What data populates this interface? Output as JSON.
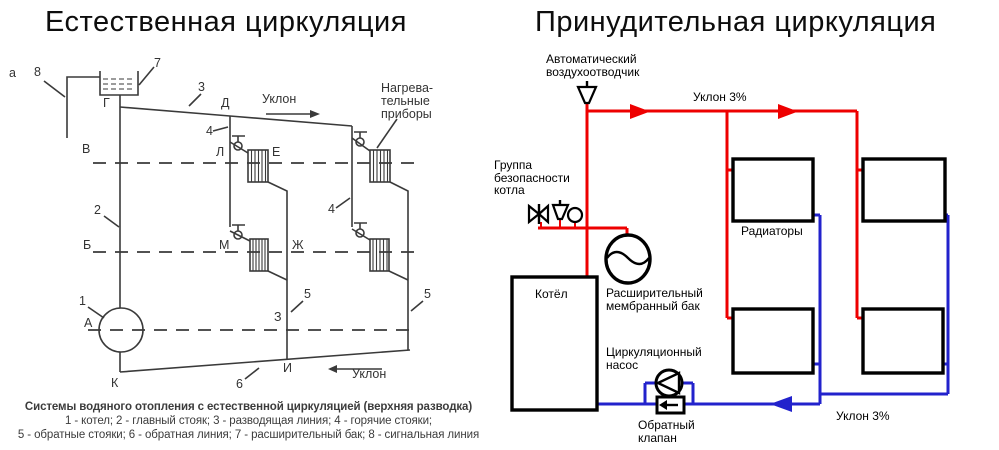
{
  "colors": {
    "supply_red": "#ee0000",
    "return_blue": "#2222cc",
    "scan_gray": "#3a3a3a"
  },
  "left": {
    "title": "Естественная циркуляция",
    "fig_label": "а",
    "slope_top": "Уклон",
    "slope_bottom": "Уклон",
    "heaters": [
      "Нагрева-",
      "тельные",
      "приборы"
    ],
    "num_labels": {
      "n1": "1",
      "n2": "2",
      "n3": "3",
      "n4a": "4",
      "n4b": "4",
      "n5a": "5",
      "n5b": "5",
      "n6": "6",
      "n7": "7",
      "n8": "8"
    },
    "point_labels": {
      "G": "Г",
      "D": "Д",
      "V": "В",
      "L": "Л",
      "E": "Е",
      "B": "Б",
      "M": "М",
      "Zh": "Ж",
      "A": "А",
      "Z": "З",
      "I": "И",
      "K": "К"
    },
    "caption_title": "Системы водяного отопления с естественной циркуляцией (верхняя разводка)",
    "caption_line2": "1 - котел; 2 - главный стояк; 3 - разводящая линия; 4 - горячие стояки;",
    "caption_line3": "5 - обратные стояки; 6 - обратная линия; 7 - расширительный бак; 8 - сигнальная линия"
  },
  "right": {
    "title": "Принудительная циркуляция",
    "air_vent": [
      "Автоматический",
      "воздухоотводчик"
    ],
    "slope_top": "Уклон 3%",
    "slope_bottom": "Уклон 3%",
    "safety_group": [
      "Группа",
      "безопасности",
      "котла"
    ],
    "boiler": "Котёл",
    "expansion_tank": [
      "Расширительный",
      "мембранный бак"
    ],
    "radiators": "Радиаторы",
    "pump": [
      "Циркуляционный",
      "насос"
    ],
    "check_valve": [
      "Обратный",
      "клапан"
    ]
  }
}
